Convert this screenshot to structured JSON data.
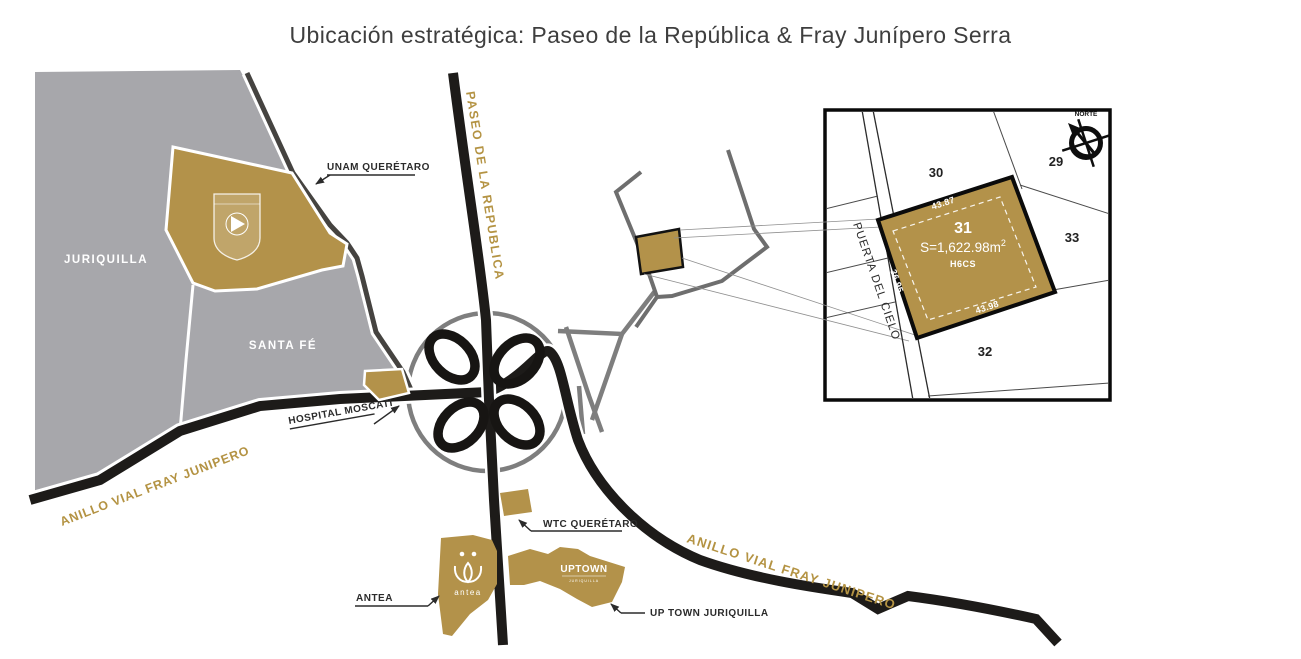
{
  "title": "Ubicación estratégica: Paseo de la República & Fray Junípero Serra",
  "regions": {
    "juriquilla": "JURIQUILLA",
    "santa_fe": "SANTA FÉ"
  },
  "roads": {
    "paseo": "PASEO DE LA REPUBLICA",
    "anillo_left": "ANILLO VIAL FRAY JUNIPERO",
    "anillo_right": "ANILLO VIAL FRAY JUNIPERO"
  },
  "callouts": {
    "unam": "UNAM QUERÉTARO",
    "hospital": "HOSPITAL MOSCATI",
    "wtc": "WTC QUERÉTARO",
    "antea": "ANTEA",
    "uptown": "UP TOWN JURIQUILLA"
  },
  "logos": {
    "antea": "antea",
    "uptown": "UPTOWN",
    "uptown_sub": "JURIQUILLA"
  },
  "inset": {
    "compass_label": "NORTE",
    "street": "PUERTA DEL CIELO",
    "lots": {
      "n29": "29",
      "n30": "30",
      "n32": "32",
      "n33": "33"
    },
    "lot31": {
      "number": "31",
      "area_prefix": "S=1,622.98m",
      "area_sup": "2",
      "code": "H6CS",
      "dims": {
        "top": "43.87",
        "bottom": "43.98",
        "left": "36.95",
        "right": "36.95"
      }
    }
  },
  "colors": {
    "gold": "#b3924a",
    "gold_text": "#b49343",
    "gray_land": "#a7a7ab",
    "road_black": "#1d1b19",
    "road_dark_gray": "#454340",
    "ramp_gray": "#7e7e7e"
  }
}
